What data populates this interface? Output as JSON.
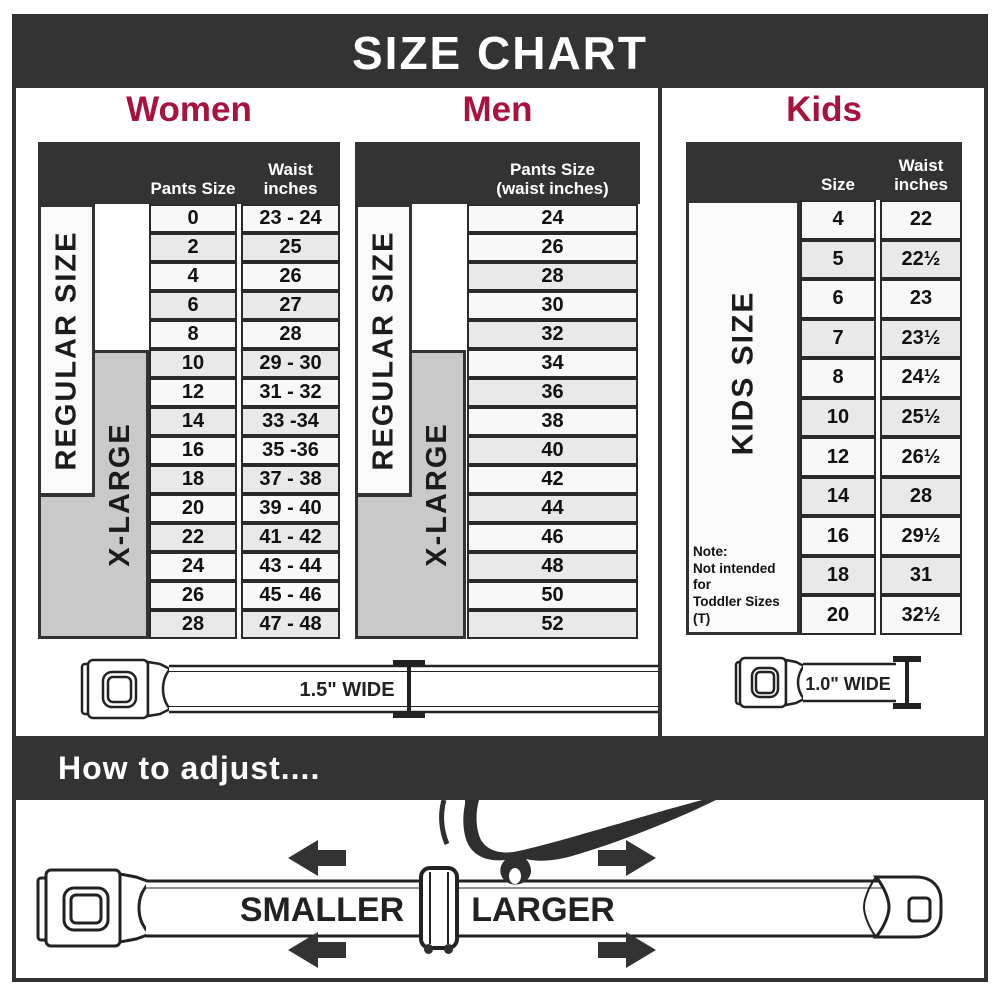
{
  "title": "SIZE CHART",
  "colors": {
    "dark": "#333333",
    "accent": "#A8123C",
    "row_light": "#F8F8F8",
    "row_shaded": "#E9E9E9",
    "large_block": "#C9C9C9"
  },
  "women": {
    "heading": "Women",
    "columns": {
      "col1": "Pants Size",
      "col2_line1": "Waist",
      "col2_line2": "inches"
    },
    "regular_label": "REGULAR SIZE",
    "xlarge_label": "X-LARGE",
    "rows": [
      {
        "size": "0",
        "waist": "23 - 24",
        "shaded": false
      },
      {
        "size": "2",
        "waist": "25",
        "shaded": true
      },
      {
        "size": "4",
        "waist": "26",
        "shaded": false
      },
      {
        "size": "6",
        "waist": "27",
        "shaded": true
      },
      {
        "size": "8",
        "waist": "28",
        "shaded": false
      },
      {
        "size": "10",
        "waist": "29 - 30",
        "shaded": true
      },
      {
        "size": "12",
        "waist": "31 - 32",
        "shaded": false
      },
      {
        "size": "14",
        "waist": "33 -34",
        "shaded": true
      },
      {
        "size": "16",
        "waist": "35 -36",
        "shaded": false
      },
      {
        "size": "18",
        "waist": "37 - 38",
        "shaded": true
      },
      {
        "size": "20",
        "waist": "39 - 40",
        "shaded": false
      },
      {
        "size": "22",
        "waist": "41 - 42",
        "shaded": true
      },
      {
        "size": "24",
        "waist": "43 - 44",
        "shaded": false
      },
      {
        "size": "26",
        "waist": "45 - 46",
        "shaded": false
      },
      {
        "size": "28",
        "waist": "47 - 48",
        "shaded": true
      }
    ]
  },
  "men": {
    "heading": "Men",
    "columns": {
      "col1_line1": "Pants Size",
      "col1_line2": "(waist inches)"
    },
    "regular_label": "REGULAR SIZE",
    "xlarge_label": "X-LARGE",
    "rows": [
      {
        "size": "24",
        "shaded": false
      },
      {
        "size": "26",
        "shaded": false
      },
      {
        "size": "28",
        "shaded": true
      },
      {
        "size": "30",
        "shaded": false
      },
      {
        "size": "32",
        "shaded": true
      },
      {
        "size": "34",
        "shaded": false
      },
      {
        "size": "36",
        "shaded": true
      },
      {
        "size": "38",
        "shaded": false
      },
      {
        "size": "40",
        "shaded": true
      },
      {
        "size": "42",
        "shaded": false
      },
      {
        "size": "44",
        "shaded": true
      },
      {
        "size": "46",
        "shaded": false
      },
      {
        "size": "48",
        "shaded": true
      },
      {
        "size": "50",
        "shaded": false
      },
      {
        "size": "52",
        "shaded": true
      }
    ]
  },
  "kids": {
    "heading": "Kids",
    "columns": {
      "col1": "Size",
      "col2_line1": "Waist",
      "col2_line2": "inches"
    },
    "label": "KIDS SIZE",
    "note_line1": "Note:",
    "note_line2": "Not intended for",
    "note_line3": "Toddler Sizes (T)",
    "rows": [
      {
        "size": "4",
        "waist": "22",
        "shaded": false
      },
      {
        "size": "5",
        "waist": "22½",
        "shaded": true
      },
      {
        "size": "6",
        "waist": "23",
        "shaded": false
      },
      {
        "size": "7",
        "waist": "23½",
        "shaded": true
      },
      {
        "size": "8",
        "waist": "24½",
        "shaded": false
      },
      {
        "size": "10",
        "waist": "25½",
        "shaded": true
      },
      {
        "size": "12",
        "waist": "26½",
        "shaded": false
      },
      {
        "size": "14",
        "waist": "28",
        "shaded": true
      },
      {
        "size": "16",
        "waist": "29½",
        "shaded": false
      },
      {
        "size": "18",
        "waist": "31",
        "shaded": true
      },
      {
        "size": "20",
        "waist": "32½",
        "shaded": false
      }
    ]
  },
  "belts": {
    "adult_width_label": "1.5\" WIDE",
    "kids_width_label": "1.0\" WIDE"
  },
  "adjust": {
    "heading": "How to adjust....",
    "smaller_label": "SMALLER",
    "larger_label": "LARGER"
  }
}
